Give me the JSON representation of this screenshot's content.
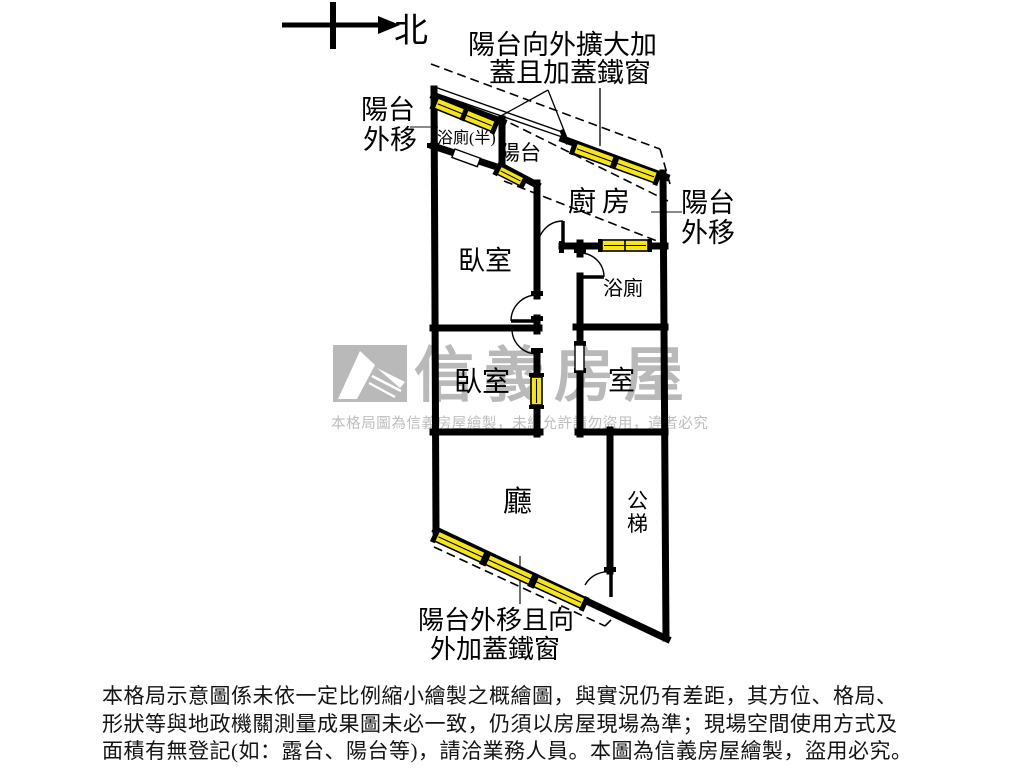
{
  "compass": {
    "label": "北"
  },
  "callouts": {
    "top_line1": "陽台向外擴大加",
    "top_line2": "蓋且加蓋鐵窗",
    "left_line1": "陽台",
    "left_line2": "外移",
    "right_line1": "陽台",
    "right_line2": "外移",
    "bottom_line1": "陽台外移且向",
    "bottom_line2": "外加蓋鐵窗"
  },
  "rooms": {
    "half_bath": "浴廁(半)",
    "balcony": "陽台",
    "kitchen": "廚房",
    "bedroom_top": "臥室",
    "bathroom": "浴廁",
    "bedroom_left": "臥室",
    "bedroom_right": "室",
    "living": "廳",
    "stairs_char1": "公",
    "stairs_char2": "梯"
  },
  "watermark": {
    "brand": "信義房屋",
    "notice": "本格局圖為信義房屋繪製，未經允許請勿盜用，違者必究"
  },
  "disclaimer": {
    "line1": "本格局示意圖係未依一定比例縮小繪製之概繪圖，與實況仍有差距，其方位、格局、",
    "line2": "形狀等與地政機關測量成果圖未必一致，仍須以房屋現場為準；現場空間使用方式及",
    "line3": "面積有無登記(如：露台、陽台等)，請洽業務人員。本圖為信義房屋繪製，盜用必究。"
  },
  "colors": {
    "wall": "#000000",
    "window_fill": "#f6e41c",
    "watermark_gray": "#b9b9b9",
    "ink": "#141414"
  }
}
